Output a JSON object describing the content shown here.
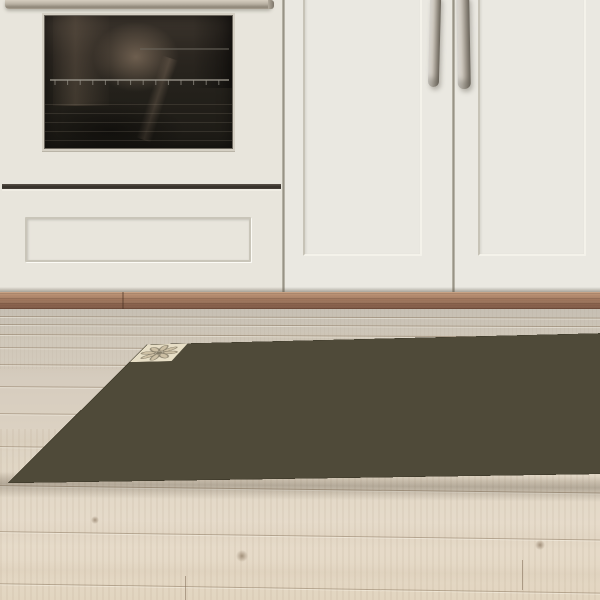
{
  "meta": {
    "description": "Kitchen photo: cream shaker cabinets with built-in oven, wood kickboard, whitewashed oak floor, patchwork encaustic-tile vinyl rug"
  },
  "scene": {
    "cabinet": {
      "face": "#eae8e1",
      "face_dark": "#e3e1d9",
      "oven_body": "#e8e5dc"
    },
    "oven": {
      "glass_frame": "#d5d0c4",
      "rack": "#9a968c",
      "rack_faint": "#6e6a60"
    },
    "kickboard": {
      "seam_x": 122
    },
    "rug": {
      "grout": "#4f4a39"
    }
  },
  "oven_geometry": {
    "glass": {
      "left": 44,
      "top": 15,
      "width": 189,
      "height": 134
    },
    "rack_y": 64,
    "rack_faint_y": 33
  },
  "doors": {
    "left": {
      "left": 285,
      "width": 167,
      "groove": {
        "left": 18,
        "top": -6,
        "width": 119,
        "height": 262
      }
    },
    "right": {
      "left": 455,
      "width": 145,
      "groove": {
        "left": 23,
        "top": -6,
        "width": 108,
        "height": 262
      }
    },
    "gap_x": 452,
    "handle_left": {
      "left": 429,
      "width": 11,
      "height": 92,
      "tilt": 1.5
    },
    "handle_right": {
      "left": 457,
      "width": 13,
      "height": 94,
      "tilt": -1.0
    }
  },
  "floor_detail": {
    "seams": [
      {
        "y": 7,
        "t": 0.15
      },
      {
        "y": 15,
        "t": 0.2
      },
      {
        "y": 25,
        "t": 0.25
      },
      {
        "y": 38,
        "t": 0.3
      },
      {
        "y": 55,
        "t": 0.35
      },
      {
        "y": 77,
        "t": 0.4
      },
      {
        "y": 104,
        "t": 0.5
      },
      {
        "y": 137,
        "t": 0.6
      },
      {
        "y": 176,
        "t": 0.7
      },
      {
        "y": 222,
        "t": 0.8
      },
      {
        "y": 274,
        "t": 0.9
      }
    ],
    "joints": [
      {
        "x": 185,
        "y": 267,
        "h": 24
      },
      {
        "x": 470,
        "y": 41,
        "h": 12
      },
      {
        "x": 95,
        "y": 109,
        "h": 14
      },
      {
        "x": 522,
        "y": 251,
        "h": 30
      }
    ],
    "knots": [
      {
        "x": 242,
        "y": 247,
        "r": 6
      },
      {
        "x": 95,
        "y": 211,
        "r": 4
      },
      {
        "x": 540,
        "y": 236,
        "r": 5
      }
    ],
    "streaks": [
      {
        "y": 21,
        "h": 10,
        "o": 0.1
      },
      {
        "y": 51,
        "h": 14,
        "o": 0.08
      },
      {
        "y": 121,
        "h": 22,
        "o": 0.12
      },
      {
        "y": 161,
        "h": 16,
        "o": 0.1
      },
      {
        "y": 211,
        "h": 26,
        "o": 0.14
      },
      {
        "y": 251,
        "h": 20,
        "o": 0.12
      }
    ],
    "streak_color": "195,176,152"
  },
  "rug": {
    "cols": 19,
    "rows": 6,
    "tile": 56,
    "palette": {
      "ink": "#35312a",
      "ink2": "#2b2820",
      "cream": "#dcd3bd",
      "cream2": "#d1c7ae",
      "beige": "#c2b69c",
      "beige2": "#b5a98d",
      "taupe": "#9f947e",
      "taupe2": "#8b8069",
      "gray": "#7e7663"
    },
    "colorways": {
      "dam": [
        "taupe",
        "cream2"
      ],
      "dam2": [
        "beige2",
        "cream"
      ],
      "scr": [
        "cream2",
        "taupe2"
      ],
      "scr2": [
        "beige",
        "gray"
      ],
      "quat": [
        "cream",
        "taupe"
      ],
      "quat2": [
        "cream2",
        "gray"
      ],
      "pet": [
        "cream",
        "gray"
      ],
      "crx": [
        "beige",
        "ink"
      ],
      "lat": [
        "cream",
        "ink"
      ],
      "strip": [
        "cream",
        "ink2"
      ],
      "flow": [
        "beige2",
        "cream"
      ],
      "crk": [
        "beige",
        "ink"
      ],
      "st8": [
        "cream",
        "ink2"
      ],
      "st8b": [
        "cream2",
        "ink2"
      ],
      "ring": [
        "beige",
        "ink"
      ],
      "medD": [
        "ink",
        "cream"
      ]
    },
    "matrix": [
      [
        "scr2",
        "quat",
        "lat",
        "flow",
        "st8b",
        "lat",
        "dam",
        "pet",
        "crx",
        "dam2",
        "st8b",
        "scr",
        "lat",
        "dam",
        "pet",
        "crx",
        "dam",
        "scr",
        "quat"
      ],
      [
        "dam2",
        "pet",
        "scr",
        "crx",
        "strip",
        "medD",
        "medD",
        "dam",
        "quat",
        "flow",
        "flow",
        "dam2",
        "strip",
        "pet",
        "scr",
        "dam",
        "crx",
        "pet",
        "dam"
      ],
      [
        "scr",
        "crx",
        "quat2",
        "pet",
        "dam",
        "medD",
        "lat",
        "dam2",
        "ring",
        "flow",
        "strip",
        "scr",
        "crk",
        "quat",
        "dam",
        "pet",
        "scr",
        "crx",
        "quat"
      ],
      [
        "dam",
        "quat",
        "scr2",
        "lat",
        "pet",
        "dam2",
        "flow",
        "scr",
        "quat2",
        "dam",
        "pet",
        "crk",
        "scr",
        "crx",
        "dam2",
        "quat",
        "pet",
        "dam",
        "scr"
      ],
      [
        "scr2",
        "dam",
        "pet",
        "lat",
        "crx",
        "quat",
        "crk",
        "scr",
        "flow",
        "pet",
        "dam",
        "scr2",
        "quat",
        "strip",
        "pet",
        "dam",
        "crx",
        "scr",
        "dam2"
      ],
      [
        "dam2",
        "scr",
        "lat",
        "st8",
        "crk",
        "scr2",
        "dam",
        "scr",
        "scr2",
        "quat",
        "dam2",
        "pet",
        "scr",
        "dam",
        "quat2",
        "crx",
        "dam",
        "scr",
        "pet"
      ]
    ]
  }
}
